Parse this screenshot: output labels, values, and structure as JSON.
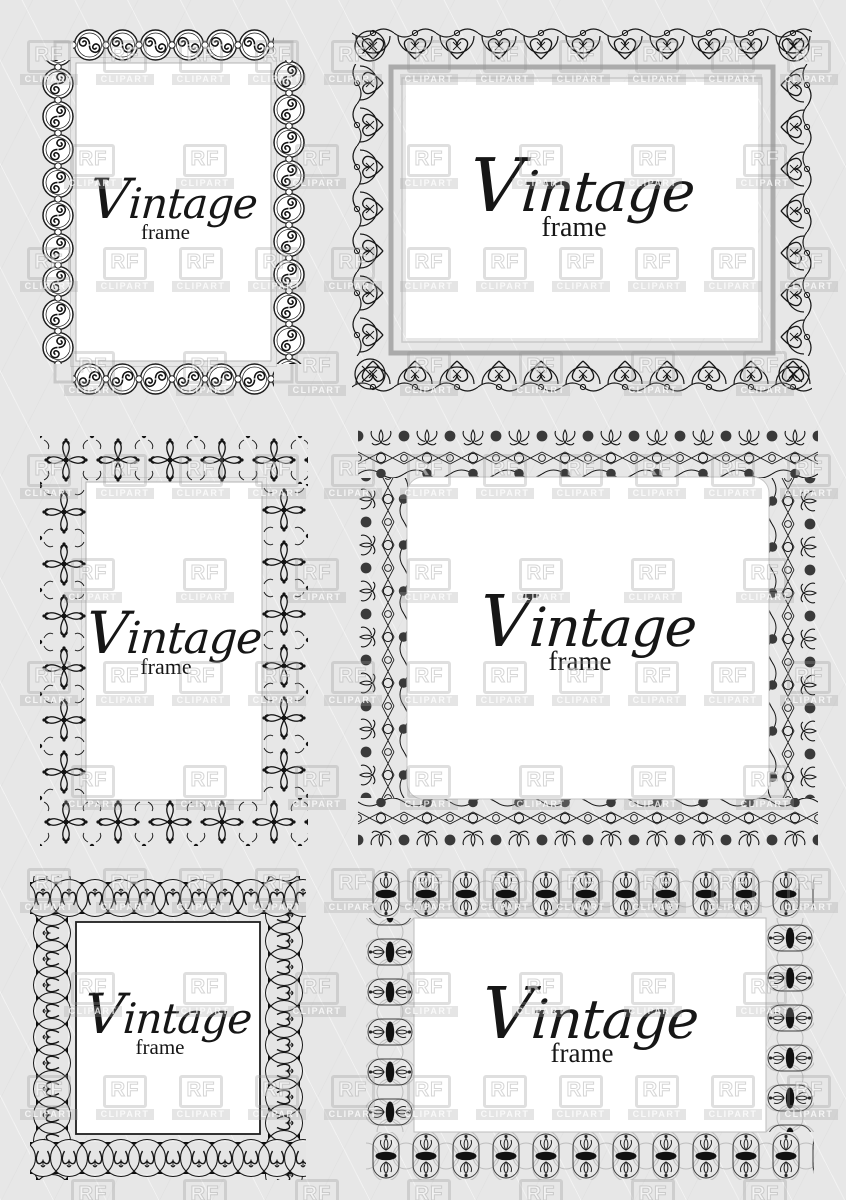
{
  "page": {
    "description": "Set of six black vintage ornamental frames on light gray background",
    "background_color": "#e7e7e7",
    "ink_color": "#1a1a1a",
    "interior_color": "#ffffff"
  },
  "watermark": {
    "logo_text": "RF",
    "brand_text": "CLIPART"
  },
  "frames": [
    {
      "name": "top-left",
      "shape": "portrait-rectangle",
      "border_style": "double-spiral-medallion-border",
      "title": "Vintage",
      "subtitle": "frame"
    },
    {
      "name": "top-right",
      "shape": "landscape-rectangle",
      "border_style": "lace-scallop-heart-border",
      "title": "Vintage",
      "subtitle": "frame"
    },
    {
      "name": "middle-left",
      "shape": "portrait-rectangle",
      "border_style": "floral-cross-medallion-border",
      "title": "Vintage",
      "subtitle": "frame"
    },
    {
      "name": "middle-right",
      "shape": "landscape-rounded-rectangle",
      "border_style": "palmette-dot-lattice-border",
      "title": "Vintage",
      "subtitle": "frame"
    },
    {
      "name": "bottom-left",
      "shape": "portrait-rectangle",
      "border_style": "interlaced-ring-knot-border-on-black",
      "title": "Vintage",
      "subtitle": "frame"
    },
    {
      "name": "bottom-right",
      "shape": "landscape-rectangle",
      "border_style": "oval-fleur-medallion-border",
      "title": "Vintage",
      "subtitle": "frame"
    }
  ]
}
